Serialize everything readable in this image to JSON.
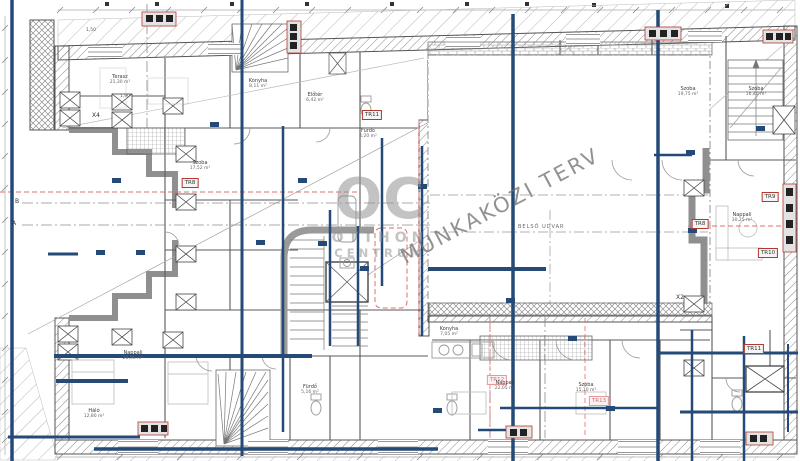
{
  "watermarks": {
    "status_text": "MUNKAKÖZI TERV",
    "logo_initials": "OC",
    "logo_line1": "OTTHON",
    "logo_line2": "CENTRUM"
  },
  "plan": {
    "courtyard_label": "BELSŐ UDVAR",
    "axis_labels": [
      "B",
      "A",
      "X4",
      "X2"
    ],
    "structural_tags": [
      "TR8",
      "TR11",
      "TR8",
      "TR9",
      "TR10",
      "TR11",
      "TR12",
      "TR13"
    ],
    "dimensions": [
      "1,50",
      "1,90"
    ],
    "rooms": [
      {
        "name": "Szoba",
        "area": "17,52 m²"
      },
      {
        "name": "Konyha",
        "area": "8,11 m²"
      },
      {
        "name": "Fürdő",
        "area": "4,20 m²"
      },
      {
        "name": "Szoba",
        "area": "19,75 m²"
      },
      {
        "name": "Szoba",
        "area": "16,40 m²"
      },
      {
        "name": "Nappali",
        "area": "30,25 m²"
      },
      {
        "name": "Nappali",
        "area": "28,96 m²"
      },
      {
        "name": "Háló",
        "area": "12,80 m²"
      },
      {
        "name": "Nappali",
        "area": "22,05 m²"
      },
      {
        "name": "Szoba",
        "area": "15,10 m²"
      },
      {
        "name": "Konyha",
        "area": "7,05 m²"
      },
      {
        "name": "Terasz",
        "area": "21,30 m²"
      },
      {
        "name": "Fürdő",
        "area": "5,16 m²"
      },
      {
        "name": "Előtér",
        "area": "6,42 m²"
      }
    ]
  },
  "colors": {
    "beam_blue": "#254a77",
    "marker_red": "#b03a2e",
    "dash_red": "#e06c6c",
    "watermark_gray": "#9b9b9b",
    "wall_gray": "#555555"
  }
}
